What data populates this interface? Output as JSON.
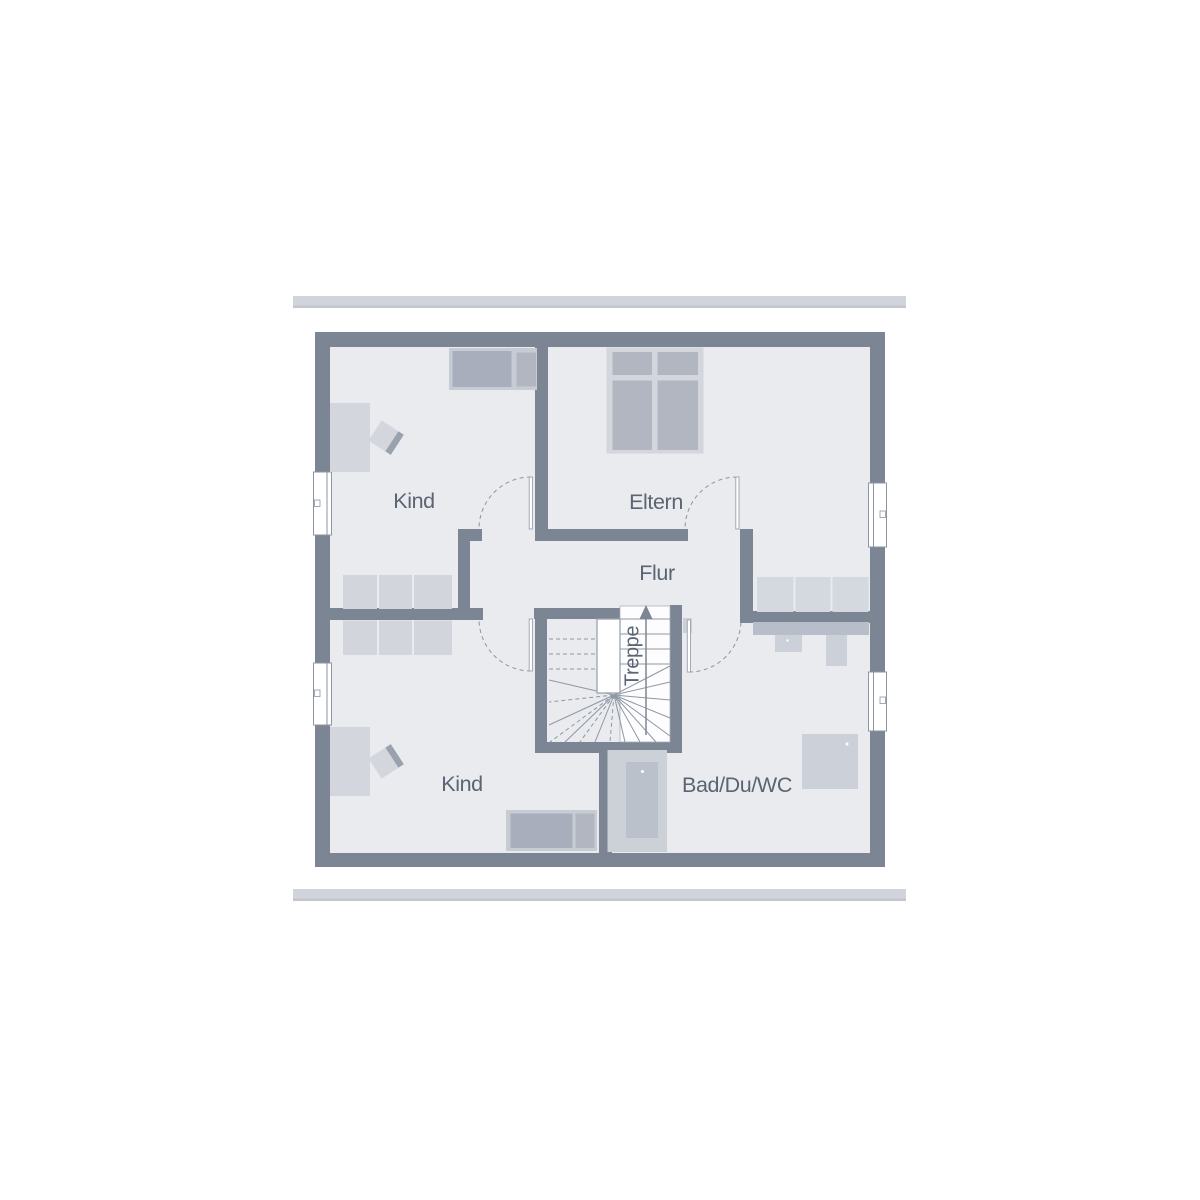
{
  "plan": {
    "title": "floor-plan-upper-storey",
    "rooms": {
      "kind_top": {
        "label": "Kind"
      },
      "eltern": {
        "label": "Eltern"
      },
      "flur": {
        "label": "Flur"
      },
      "kind_bottom": {
        "label": "Kind"
      },
      "bad": {
        "label": "Bad/Du/WC"
      },
      "treppe": {
        "label": "Treppe"
      }
    },
    "colors": {
      "wall": "#7b8593",
      "floor": "#e9ebef",
      "roof_bar": "#d2d4db",
      "label_text": "#5b6472",
      "furniture_light": "#d3d6dd",
      "furniture_medium": "#b1b6c1",
      "furniture_dark": "#a8aebb",
      "fixture": "#ccd0d8",
      "vanity": "#b8bec9",
      "line": "#9aa2ae",
      "window_white": "#ffffff"
    },
    "furniture_names": [
      "bed-icon",
      "wardrobe-icon",
      "desk-icon",
      "chair-icon",
      "shelf-icon",
      "double-bed-icon",
      "closet-icon",
      "vanity-icon",
      "washbasin-icon",
      "wc-icon",
      "bathtub-icon",
      "shower-icon",
      "stairs-up-arrow-icon"
    ],
    "counts": {
      "windows": 4,
      "door_swings": 4
    }
  }
}
